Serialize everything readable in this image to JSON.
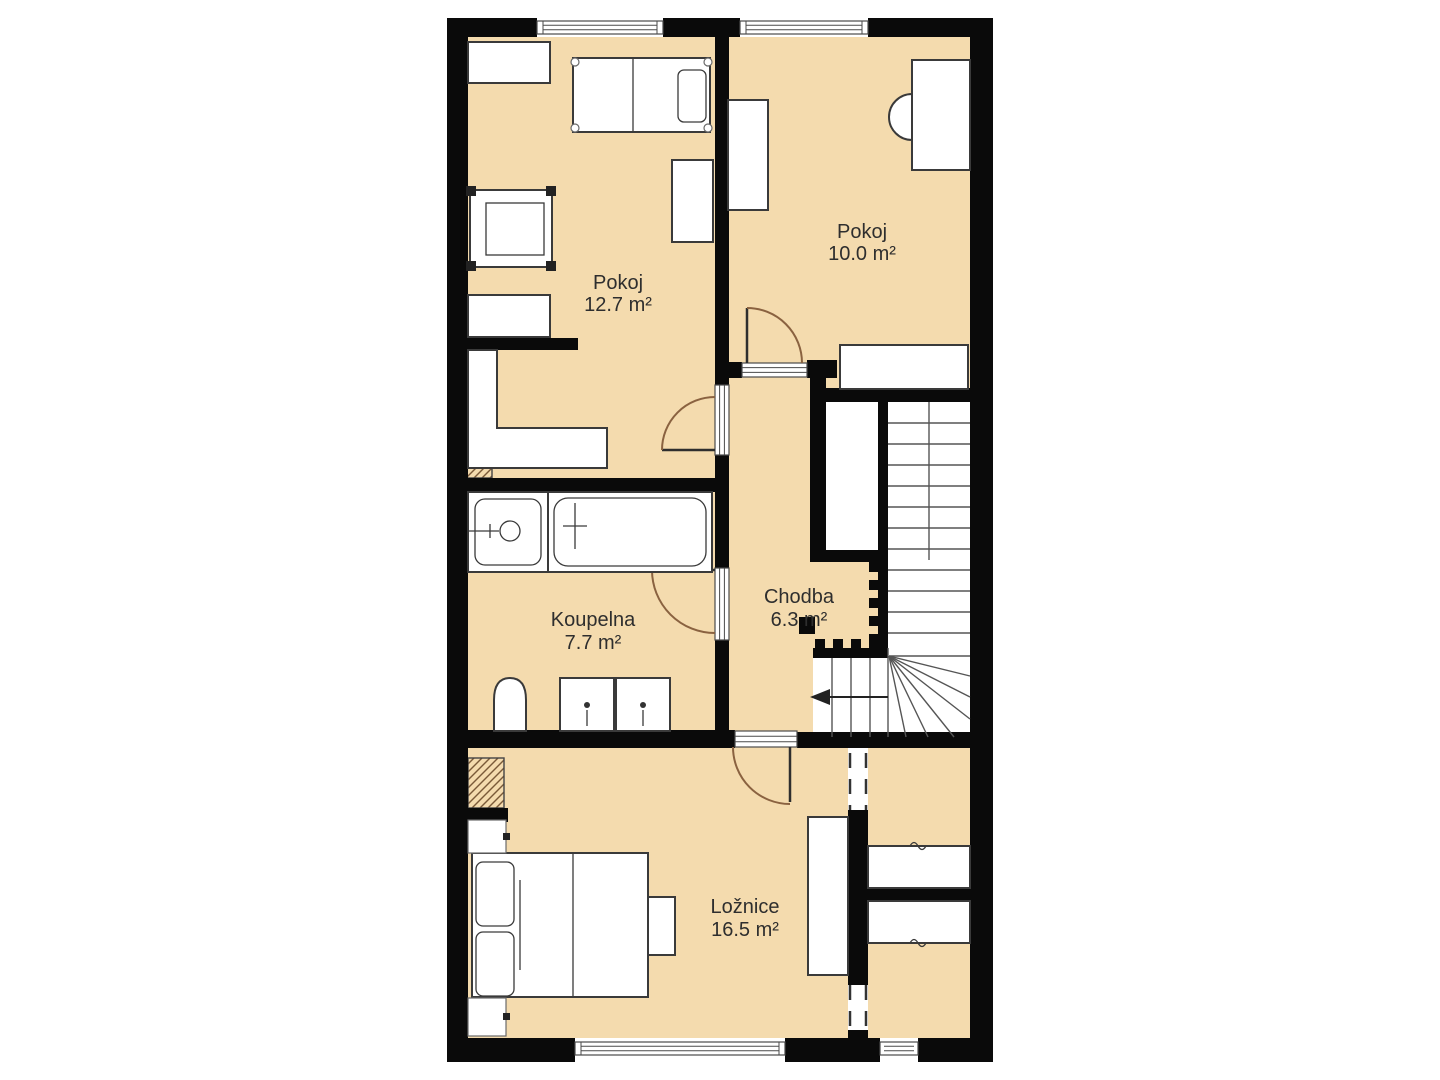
{
  "plan": {
    "rooms": [
      {
        "id": "pokoj-12",
        "name": "Pokoj",
        "area": "12.7 m²"
      },
      {
        "id": "pokoj-10",
        "name": "Pokoj",
        "area": "10.0 m²"
      },
      {
        "id": "koupelna",
        "name": "Koupelna",
        "area": "7.7 m²"
      },
      {
        "id": "chodba",
        "name": "Chodba",
        "area": "6.3 m²"
      },
      {
        "id": "loznice",
        "name": "Ložnice",
        "area": "16.5 m²"
      }
    ],
    "stairs": {
      "direction_icon": "arrow-left"
    },
    "colors": {
      "floor": "#f4dbae",
      "wall": "#0a0a0a",
      "door_arc": "#8a6240",
      "furniture_outline": "#3a3a3a",
      "stair_line": "#555555",
      "dashed": "#333333",
      "text": "#2e2e2e",
      "background": "#ffffff",
      "hatch": "#7a5a38"
    }
  }
}
